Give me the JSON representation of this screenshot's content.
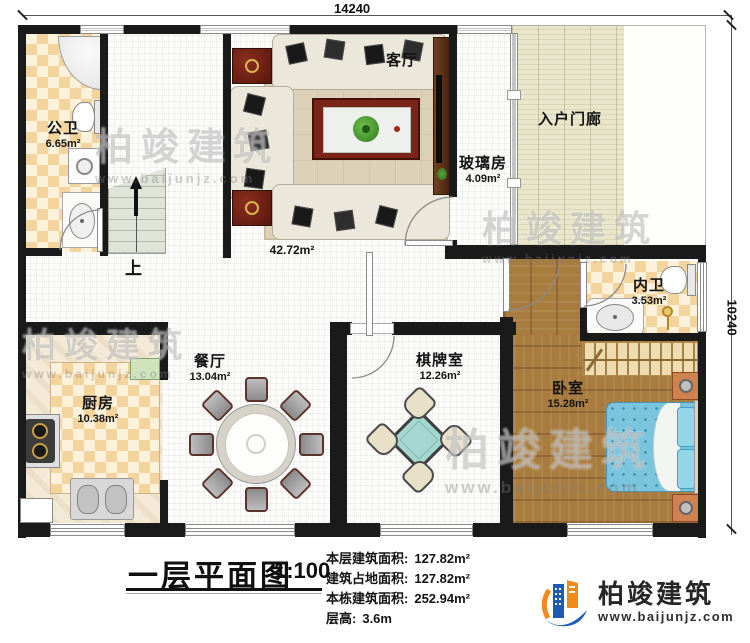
{
  "dims": {
    "top": "14240",
    "right": "10240"
  },
  "rooms": [
    {
      "id": "public-bath",
      "name": "公卫",
      "area": "6.65m²"
    },
    {
      "id": "living-room",
      "name": "客厅",
      "area": "42.72m²"
    },
    {
      "id": "glass-room",
      "name": "玻璃房",
      "area": "4.09m²"
    },
    {
      "id": "entry-porch",
      "name": "入户门廊",
      "area": ""
    },
    {
      "id": "inner-bath",
      "name": "内卫",
      "area": "3.53m²"
    },
    {
      "id": "kitchen",
      "name": "厨房",
      "area": "10.38m²"
    },
    {
      "id": "dining-room",
      "name": "餐厅",
      "area": "13.04m²"
    },
    {
      "id": "chess-room",
      "name": "棋牌室",
      "area": "12.26m²"
    },
    {
      "id": "bedroom",
      "name": "卧室",
      "area": "15.28m²"
    }
  ],
  "stairs": {
    "up": "上"
  },
  "title_block": {
    "title": "一层平面图",
    "scale": "1:100",
    "stats": [
      {
        "label": "本层建筑面积:",
        "value": "127.82m²"
      },
      {
        "label": "建筑占地面积:",
        "value": "127.82m²"
      },
      {
        "label": "本栋建筑面积:",
        "value": "252.94m²"
      },
      {
        "label": "层高:",
        "value": "3.6m"
      }
    ]
  },
  "logo": {
    "name": "柏竣建筑",
    "url": "www.baijunjz.com"
  },
  "watermark": {
    "text": "柏竣建筑",
    "sub": "www.baijunjz.com"
  },
  "colors": {
    "wall": "#1a1a1a",
    "wood_floor": "#a87c3e",
    "tile": "#f3d49c",
    "porch": "#e9e6cb",
    "bed": "#7ac4dd",
    "mahjong_table": "#a5d6d0",
    "logo_blue": "#1d5bb5",
    "logo_orange": "#f08a1c"
  }
}
